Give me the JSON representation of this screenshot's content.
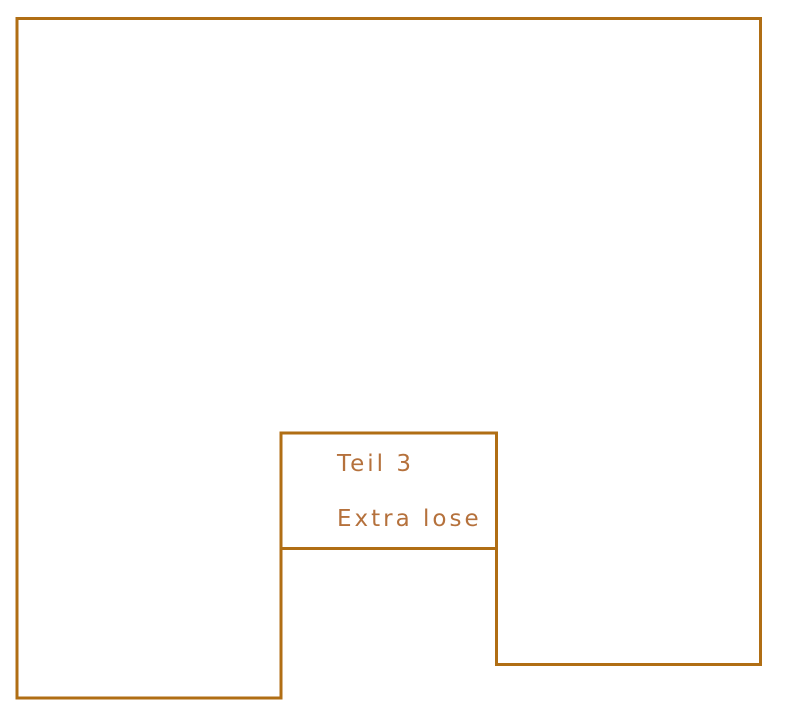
{
  "piece": {
    "name": "Teil 3",
    "note": "Extra lose"
  },
  "colors": {
    "outline": "#b06e14",
    "text": "#b5713c"
  },
  "shape": {
    "outer_points": "17,18.5 760.5,18.5 760.5,664.5 496.5,664.5 496.5,433 281,433 281,698 17,698",
    "divider_x1": "281",
    "divider_y1": "548.5",
    "divider_x2": "496.5",
    "divider_y2": "548.5",
    "stroke_width": "3"
  }
}
